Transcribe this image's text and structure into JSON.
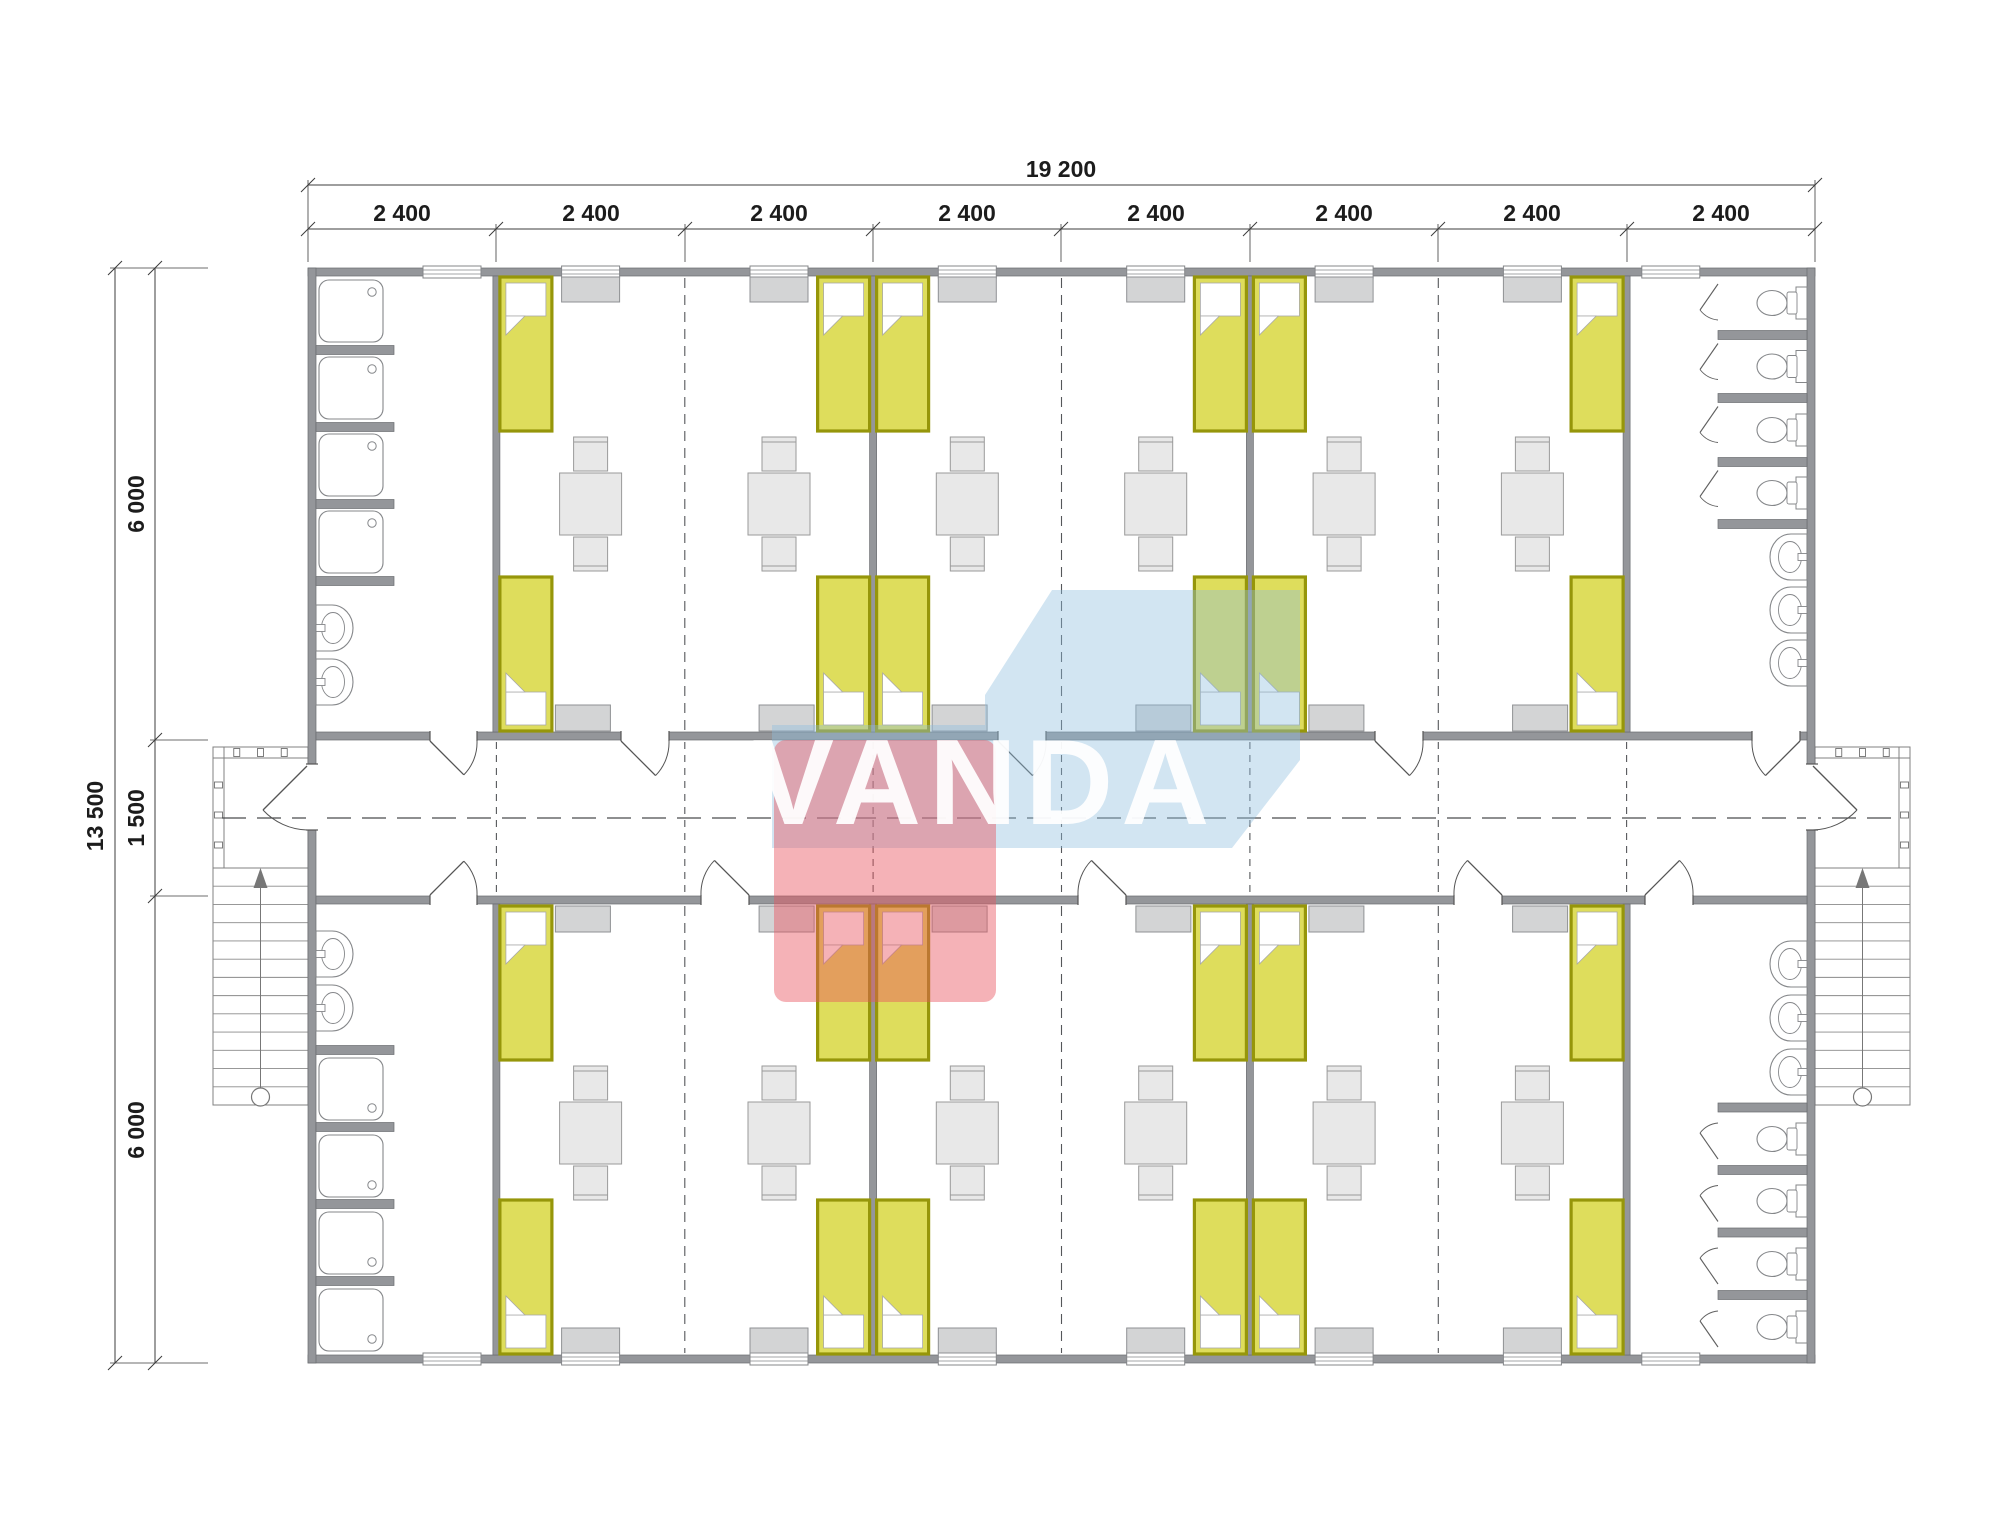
{
  "dimensions": {
    "top": {
      "overall": "19 200",
      "segments": [
        "2 400",
        "2 400",
        "2 400",
        "2 400",
        "2 400",
        "2 400",
        "2 400",
        "2 400"
      ]
    },
    "left": {
      "overall": "13 500",
      "segments": [
        "6 000",
        "1 500",
        "6 000"
      ]
    }
  },
  "watermark": {
    "text": "VANDA",
    "red_color": "#e9545f",
    "blue_color": "#8fbfdf"
  },
  "colors": {
    "wall": "#94969a",
    "wall_edge": "#6a6c70",
    "bed_fill": "#dedd5c",
    "bed_border": "#96960a",
    "furniture_fill": "#e8e8e8",
    "wardrobe_fill": "#d3d4d5",
    "fixture_stroke": "#85878a",
    "dash_line": "#55575a",
    "dimension_line": "#3c3c3c"
  }
}
